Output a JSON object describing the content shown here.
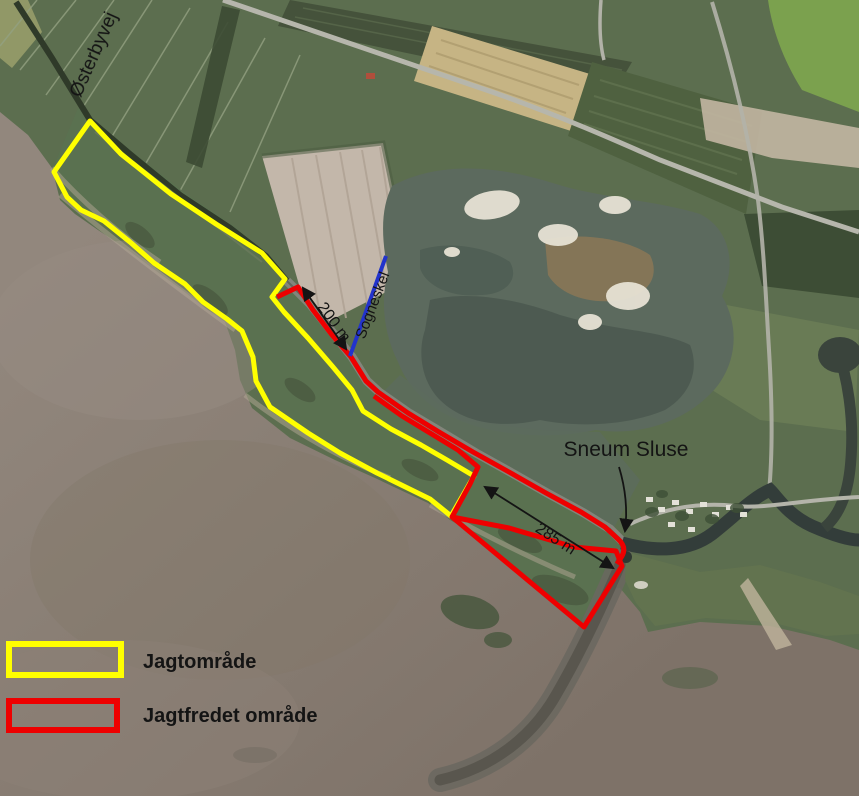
{
  "labels": {
    "osterbyvej": "Østerbyvej",
    "sogneskel": "Sogneskel",
    "sneum_sluse": "Sneum Sluse",
    "distance_200": "200 m",
    "distance_285": "285 m"
  },
  "legend": {
    "items": [
      {
        "label": "Jagtområde",
        "color": "#ffff00"
      },
      {
        "label": "Jagtfredet område",
        "color": "#ee0000"
      }
    ]
  },
  "overlay": {
    "jagtomraade_color": "#ffff00",
    "jagtfredet_color": "#ee0000",
    "sogneskel_color": "#2233cc",
    "annotation_color": "#141414"
  }
}
